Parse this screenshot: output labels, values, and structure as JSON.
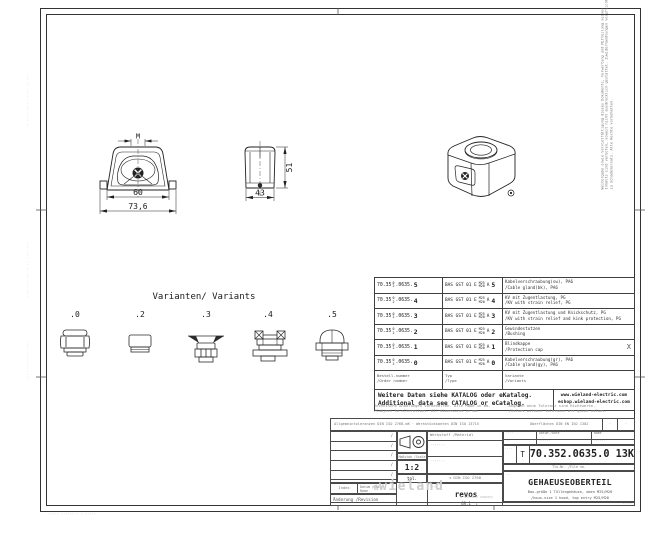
{
  "sheet": {
    "ink": "#222222",
    "watermark_gray": "#cdcdcd"
  },
  "drawing": {
    "front": {
      "dim_m": "M",
      "dim_inner": "60",
      "dim_outer": "73,6"
    },
    "side": {
      "dim_width": "43",
      "dim_height": "51"
    }
  },
  "variants": {
    "title": "Varianten/ Variants",
    "labels": [
      ".0",
      ".2",
      ".3",
      ".4",
      ".5"
    ]
  },
  "table": {
    "rows": [
      {
        "part_pre": "70.35",
        "part_sup": "0",
        "part_sub": "2",
        "part_mid": ".0635.",
        "variant": "5",
        "type": "BAS GST 01 E",
        "size_top": "M25",
        "size_bot": "M20",
        "sel": "A",
        "desc_de": "Kabelverschraubung(sw), PA6",
        "desc_en": "/Cable gland(bk), PA6",
        "flag": ""
      },
      {
        "part_pre": "70.35",
        "part_sup": "0",
        "part_sub": "2",
        "part_mid": ".0635.",
        "variant": "4",
        "type": "BAS GST 01 E",
        "size_top": "M25",
        "size_bot": "M20",
        "sel": "A",
        "desc_de": "KV mit Zugentlastung, PG",
        "desc_en": "/KV with strain relief, PG",
        "flag": ""
      },
      {
        "part_pre": "70.35",
        "part_sup": "0",
        "part_sub": "2",
        "part_mid": ".0635.",
        "variant": "3",
        "type": "BAS GST 01 E",
        "size_top": "M25",
        "size_bot": "M20",
        "sel": "A",
        "desc_de": "KV mit Zugentlastung und Knickschutz, PG",
        "desc_en": "/KV with strain relief and kink protection, PG",
        "flag": ""
      },
      {
        "part_pre": "70.35",
        "part_sup": "0",
        "part_sub": "2",
        "part_mid": ".0635.",
        "variant": "2",
        "type": "BAS GST 01 E",
        "size_top": "M25",
        "size_bot": "M20",
        "sel": "A",
        "desc_de": "Gewindestutzen",
        "desc_en": "/Bushing",
        "flag": ""
      },
      {
        "part_pre": "70.35",
        "part_sup": "0",
        "part_sub": "2",
        "part_mid": ".0635.",
        "variant": "1",
        "type": "BAS GST 01 E",
        "size_top": "M25",
        "size_bot": "M20",
        "sel": "A",
        "desc_de": "Blindkappe",
        "desc_en": "/Protection cap",
        "flag": "X"
      },
      {
        "part_pre": "70.35",
        "part_sup": "0",
        "part_sub": "2",
        "part_mid": ".0635.",
        "variant": "0",
        "type": "BAS GST 01 E",
        "size_top": "M25",
        "size_bot": "M20",
        "sel": "A",
        "desc_de": "Kabelverschraubung(gr), PA6",
        "desc_en": "/Cable gland(gy), PA6",
        "flag": ""
      }
    ],
    "legend": {
      "order_de": "Bestell-nummer",
      "order_en": "/Order number",
      "type_de": "Typ",
      "type_en": "/Type",
      "var_de": "Variante",
      "var_en": "/Variants"
    },
    "catalog": {
      "de": "Weitere Daten siehe KATALOG oder eKatalog.",
      "en": "Additional data see CATALOG or eCatalog.",
      "url1": "www.wieland-electric.com",
      "url2": "eshop.wieland-electric.com"
    },
    "fineprint": {
      "l1": "Technische Änderungen vorbehalten. Alle Maße in mm.",
      "l2": "/Subject to alterations. All dimensions in mm.",
      "r1": "Angaben ohne Toleranz sind Richtwerte.",
      "r2": "/Values without tolerance are guide values."
    }
  },
  "titleblock": {
    "note_left": "Allgemeintoleranzen DIN ISO 2768-mK · Werkstückkanten DIN ISO 13715",
    "note_right": "Oberflächen DIN EN ISO 1302",
    "box_a": "·",
    "box_b": "·",
    "rev_slash": "/",
    "index_label": "Index",
    "date_label": "Datum /Date",
    "name_label": "Name",
    "revision_label": "Änderung /Revision",
    "scale_label": "Maßstab /Scale",
    "scale": "1:2",
    "tol_label": "tol.",
    "tol_value": "± DIN ISO 2768",
    "material_label": "Werkstoff /Material",
    "material_1": "·······",
    "material_2": "·······",
    "meta_c1": "Datum /Date",
    "meta_c2": "Name",
    "meta_v0": "····",
    "meta_v1": "······",
    "meta_v2": "······",
    "doc_note": "··",
    "doc_letter": "T",
    "part_number": "70.352.0635.0 13K",
    "file_note": "Tln-Nr. /File no.",
    "series_label": "···",
    "series": "revos",
    "series_size": "GR.1",
    "title_label": "···",
    "title": "GEHAEUSEOBERTEIL",
    "subtitle_de": "Bau.größe 1 Tüllengehäuse, oben M25/M20",
    "subtitle_en": "/hous.size 1 hood, top entry M25/M20",
    "watermark_icon": "✿",
    "watermark": "wieland",
    "watermark_caption": "a wieland company",
    "sheet_mark": "1",
    "corner_note": "·····"
  },
  "edges": {
    "left_1": "·· ···· ····· ···· ·· ···",
    "left_2": "···· ··· ····· ·· ···· ···",
    "left_3": "··· ····· ··· ····",
    "copy_1": "Weitergabe sowie Vervielfältigung dieses Dokuments, Verwertung und Mitteilung seines",
    "copy_2": "Inhalts sind verboten, soweit nicht ausdrücklich gestattet. Zuwiderhandlungen verpflichten",
    "copy_3": "zu Schadenersatz. Alle Rechte vorbehalten.",
    "footer": "····· ········ · ·····"
  }
}
